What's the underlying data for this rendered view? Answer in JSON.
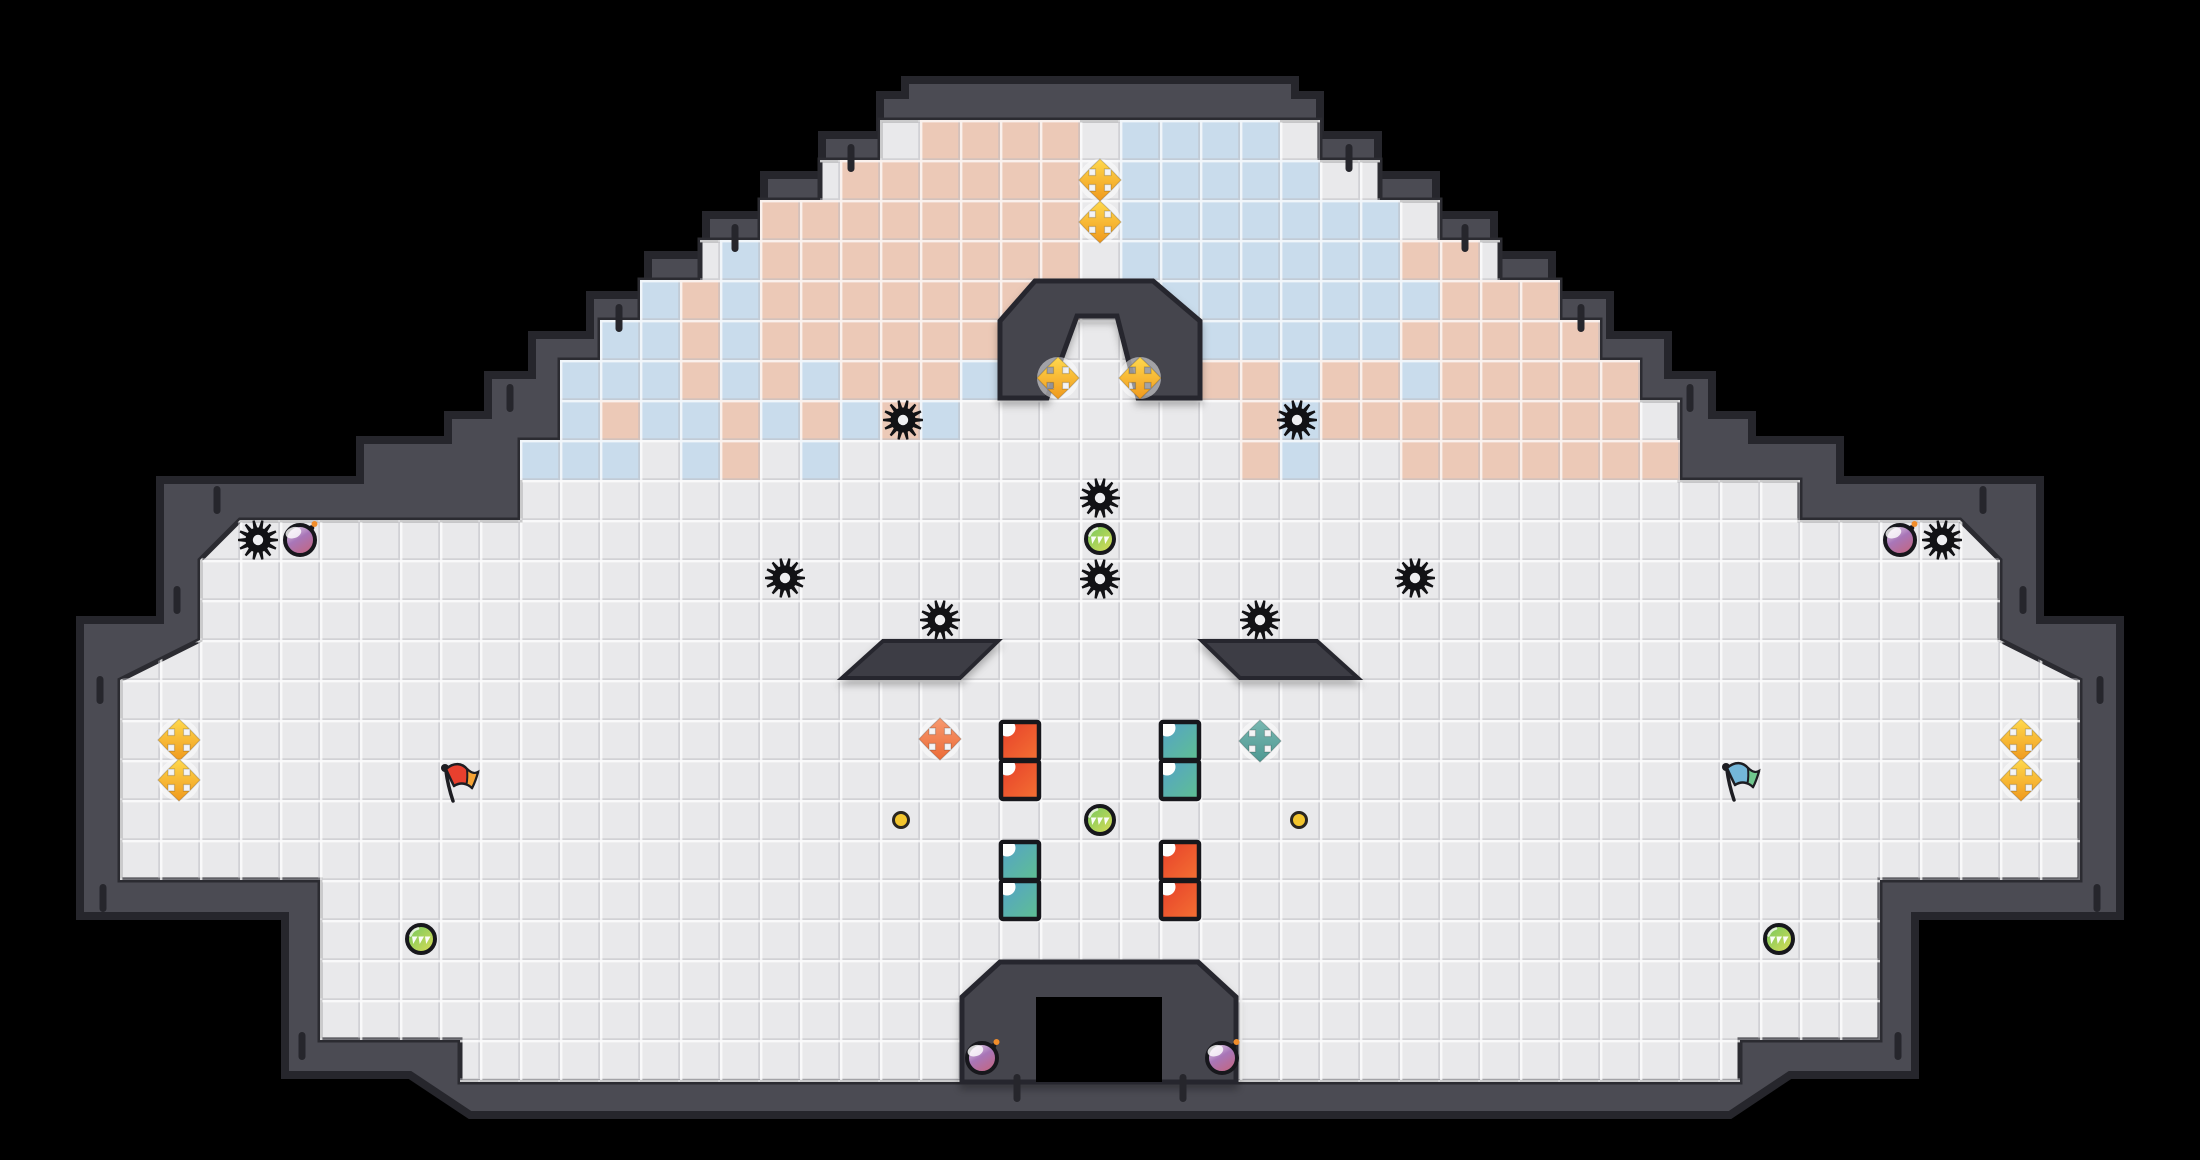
{
  "scene": {
    "width": 2200,
    "height": 1160,
    "tile_size": 40,
    "palette": {
      "background": "#000000",
      "wall": "#4b4b53",
      "wall_outline": "#26262c",
      "floor": "#e9e9eb",
      "structure": "#45454d",
      "structure_outline": "#28282e",
      "pit": "#000000",
      "tile_pink": "#ecc9b7",
      "tile_blue": "#c9dcec",
      "grid_light": "#ffffff",
      "grid_dark": "#b9b9bf",
      "gear": "#121215",
      "gear_hole": "#efeff1",
      "gold_cross": [
        "#ffd94e",
        "#f0991d"
      ],
      "orange_cross": [
        "#f79a70",
        "#ec6b36"
      ],
      "teal_cross": [
        "#79b8b1",
        "#4e9892"
      ],
      "cross_halo": "#ffffff",
      "square_red": [
        "#e63f2a",
        "#f47133"
      ],
      "square_teal": [
        "#54a1ca",
        "#5fc091"
      ],
      "square_notch": "#ffffff",
      "orb": [
        "#6fc75f",
        "#dedd55"
      ],
      "orb_teeth": "#ffffff",
      "bomb": [
        "#e9d9ee",
        "#a876b8",
        "#c5657f"
      ],
      "bomb_spark": "#f08d2b",
      "flag_red": [
        "#e8402e",
        "#f5a335"
      ],
      "flag_blue": [
        "#74b7d9",
        "#70c78e"
      ],
      "flag_pole": "#1d1d22",
      "dot_fill": "#f3c52d",
      "dot_outline": "#2a2620",
      "outline_dark": "#17171c",
      "tick": "#26262c"
    }
  },
  "level": {
    "outer_wall": [
      [
        905,
        80
      ],
      [
        1295,
        80
      ],
      [
        1295,
        95
      ],
      [
        1320,
        95
      ],
      [
        1320,
        135
      ],
      [
        1378,
        135
      ],
      [
        1378,
        175
      ],
      [
        1436,
        175
      ],
      [
        1436,
        215
      ],
      [
        1494,
        215
      ],
      [
        1494,
        255
      ],
      [
        1552,
        255
      ],
      [
        1552,
        295
      ],
      [
        1610,
        295
      ],
      [
        1610,
        335
      ],
      [
        1668,
        335
      ],
      [
        1668,
        375
      ],
      [
        1712,
        375
      ],
      [
        1712,
        415
      ],
      [
        1752,
        415
      ],
      [
        1752,
        440
      ],
      [
        1840,
        440
      ],
      [
        1840,
        480
      ],
      [
        2040,
        480
      ],
      [
        2040,
        620
      ],
      [
        2120,
        620
      ],
      [
        2120,
        916
      ],
      [
        1915,
        916
      ],
      [
        1915,
        1075
      ],
      [
        1790,
        1075
      ],
      [
        1730,
        1115
      ],
      [
        470,
        1115
      ],
      [
        410,
        1075
      ],
      [
        285,
        1075
      ],
      [
        285,
        916
      ],
      [
        80,
        916
      ],
      [
        80,
        620
      ],
      [
        160,
        620
      ],
      [
        160,
        480
      ],
      [
        360,
        480
      ],
      [
        360,
        440
      ],
      [
        448,
        440
      ],
      [
        448,
        415
      ],
      [
        488,
        415
      ],
      [
        488,
        375
      ],
      [
        532,
        375
      ],
      [
        532,
        335
      ],
      [
        590,
        335
      ],
      [
        590,
        295
      ],
      [
        648,
        295
      ],
      [
        648,
        255
      ],
      [
        706,
        255
      ],
      [
        706,
        215
      ],
      [
        764,
        215
      ],
      [
        764,
        175
      ],
      [
        822,
        175
      ],
      [
        822,
        135
      ],
      [
        880,
        135
      ],
      [
        880,
        95
      ],
      [
        905,
        95
      ]
    ],
    "floor": [
      [
        880,
        120
      ],
      [
        1320,
        120
      ],
      [
        1320,
        160
      ],
      [
        1380,
        160
      ],
      [
        1380,
        200
      ],
      [
        1440,
        200
      ],
      [
        1440,
        240
      ],
      [
        1500,
        240
      ],
      [
        1500,
        280
      ],
      [
        1560,
        280
      ],
      [
        1560,
        320
      ],
      [
        1600,
        320
      ],
      [
        1600,
        360
      ],
      [
        1640,
        360
      ],
      [
        1640,
        400
      ],
      [
        1680,
        400
      ],
      [
        1680,
        480
      ],
      [
        1800,
        480
      ],
      [
        1800,
        520
      ],
      [
        1960,
        520
      ],
      [
        2000,
        560
      ],
      [
        2000,
        640
      ],
      [
        2080,
        680
      ],
      [
        2080,
        880
      ],
      [
        1880,
        880
      ],
      [
        1880,
        1040
      ],
      [
        1740,
        1040
      ],
      [
        1740,
        1082
      ],
      [
        460,
        1082
      ],
      [
        460,
        1040
      ],
      [
        320,
        1040
      ],
      [
        320,
        880
      ],
      [
        120,
        880
      ],
      [
        120,
        680
      ],
      [
        200,
        640
      ],
      [
        200,
        560
      ],
      [
        240,
        520
      ],
      [
        520,
        520
      ],
      [
        520,
        440
      ],
      [
        560,
        440
      ],
      [
        560,
        360
      ],
      [
        600,
        360
      ],
      [
        600,
        320
      ],
      [
        640,
        320
      ],
      [
        640,
        280
      ],
      [
        700,
        280
      ],
      [
        700,
        240
      ],
      [
        760,
        240
      ],
      [
        760,
        200
      ],
      [
        820,
        200
      ],
      [
        820,
        160
      ],
      [
        880,
        160
      ]
    ],
    "tilemap": {
      "first_col": 9,
      "first_row": 3,
      "legend": {
        ".": "none",
        "P": "pink",
        "B": "blue"
      },
      "rows": [
        "..............PPPP.BBBB..........",
        "............PPPPPP.BBBBB.........",
        "..........PPPPPPPP.BBBBBBB.......",
        ".........BPPPPPPPP.BBBBBBBPP.....",
        ".......BPBPPPPPPPP.BBBBBBBBPPP...",
        "......BBPBPPPPPP.....BBBBBPPPPP..",
        ".....BBBPBPBPPPB.....PPBPPBPPPPP.",
        ".....BPBBPBPBPB.......PBPPPPPPPP",
        "....BBB.BP.B..........PB..PPPPPPP"
      ]
    },
    "structures": {
      "peak_arch": [
        [
          1035,
          281
        ],
        [
          1153,
          281
        ],
        [
          1200,
          321
        ],
        [
          1200,
          398
        ],
        [
          1138,
          398
        ],
        [
          1117,
          316
        ],
        [
          1077,
          316
        ],
        [
          1047,
          398
        ],
        [
          1000,
          398
        ],
        [
          1000,
          321
        ]
      ],
      "platform_left": [
        [
          883,
          641
        ],
        [
          998,
          641
        ],
        [
          960,
          678
        ],
        [
          842,
          678
        ]
      ],
      "platform_right": [
        [
          1202,
          641
        ],
        [
          1317,
          641
        ],
        [
          1358,
          678
        ],
        [
          1240,
          678
        ]
      ],
      "doorway": [
        [
          962,
          997
        ],
        [
          1000,
          962
        ],
        [
          1198,
          962
        ],
        [
          1236,
          997
        ],
        [
          1236,
          1082
        ],
        [
          962,
          1082
        ]
      ],
      "pit": [
        1036,
        997,
        126,
        85
      ]
    },
    "wall_ticks": [
      [
        851,
        158
      ],
      [
        1349,
        158
      ],
      [
        735,
        238
      ],
      [
        1465,
        238
      ],
      [
        619,
        318
      ],
      [
        1581,
        318
      ],
      [
        510,
        398
      ],
      [
        1690,
        398
      ],
      [
        217,
        500
      ],
      [
        1983,
        500
      ],
      [
        177,
        600
      ],
      [
        2023,
        600
      ],
      [
        100,
        690
      ],
      [
        2100,
        690
      ],
      [
        103,
        898
      ],
      [
        2097,
        898
      ],
      [
        302,
        1046
      ],
      [
        1898,
        1046
      ],
      [
        1017,
        1088
      ],
      [
        1183,
        1088
      ]
    ]
  },
  "entities": {
    "gears": [
      [
        258,
        540
      ],
      [
        1942,
        540
      ],
      [
        903,
        420
      ],
      [
        1297,
        420
      ],
      [
        785,
        578
      ],
      [
        1415,
        578
      ],
      [
        940,
        620
      ],
      [
        1260,
        620
      ],
      [
        1100,
        498
      ],
      [
        1100,
        579
      ]
    ],
    "crosses": [
      {
        "x": 1100,
        "y": 180,
        "color": "gold"
      },
      {
        "x": 1100,
        "y": 222,
        "color": "gold"
      },
      {
        "x": 1058,
        "y": 378,
        "color": "gold"
      },
      {
        "x": 1140,
        "y": 378,
        "color": "gold"
      },
      {
        "x": 179,
        "y": 740,
        "color": "gold"
      },
      {
        "x": 179,
        "y": 780,
        "color": "gold"
      },
      {
        "x": 2021,
        "y": 740,
        "color": "gold"
      },
      {
        "x": 2021,
        "y": 780,
        "color": "gold"
      },
      {
        "x": 940,
        "y": 739,
        "color": "orange"
      },
      {
        "x": 1260,
        "y": 741,
        "color": "teal"
      }
    ],
    "flags": [
      {
        "x": 458,
        "y": 781,
        "color": "red"
      },
      {
        "x": 1739,
        "y": 780,
        "color": "blue"
      }
    ],
    "bombs": [
      [
        300,
        540
      ],
      [
        1900,
        540
      ],
      [
        982,
        1058
      ],
      [
        1222,
        1058
      ]
    ],
    "orbs": [
      [
        1100,
        539
      ],
      [
        1100,
        820
      ],
      [
        421,
        939
      ],
      [
        1779,
        939
      ]
    ],
    "dots": [
      [
        901,
        820
      ],
      [
        1299,
        820
      ]
    ],
    "squares": [
      {
        "x": 1020,
        "y": 741,
        "color": "red"
      },
      {
        "x": 1020,
        "y": 780,
        "color": "red"
      },
      {
        "x": 1180,
        "y": 741,
        "color": "teal"
      },
      {
        "x": 1180,
        "y": 780,
        "color": "teal"
      },
      {
        "x": 1020,
        "y": 861,
        "color": "teal"
      },
      {
        "x": 1020,
        "y": 900,
        "color": "teal"
      },
      {
        "x": 1180,
        "y": 861,
        "color": "red"
      },
      {
        "x": 1180,
        "y": 900,
        "color": "red"
      }
    ]
  }
}
